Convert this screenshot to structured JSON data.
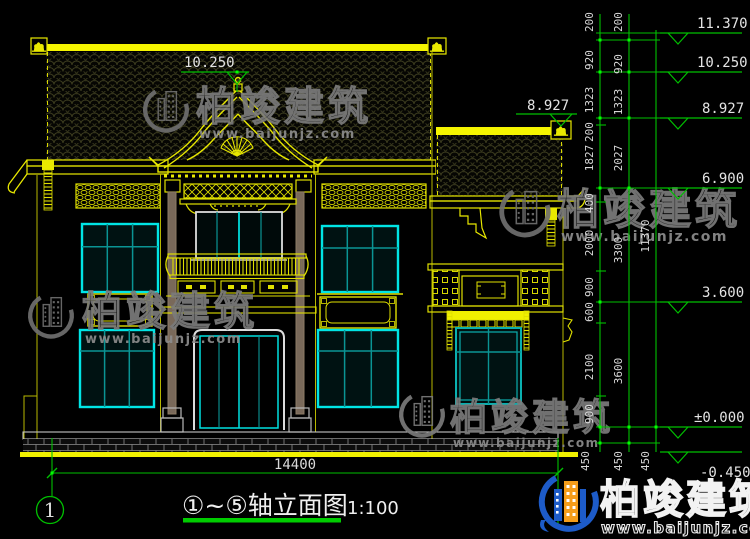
{
  "drawing": {
    "title": "①~⑤轴立面图",
    "scale": "1:100",
    "axis_start_bubble": "1",
    "total_width_dim": "14400",
    "levels": [
      "11.370",
      "10.250",
      "8.927",
      "6.900",
      "3.600",
      "±0.000",
      "-0.450"
    ],
    "gable_level": "10.250",
    "wing_level": "8.927",
    "dim_chain_inner": [
      "200",
      "920",
      "1323",
      "200",
      "1827",
      "400",
      "2000",
      "900",
      "600",
      "2100",
      "900",
      "450"
    ],
    "dim_chain_middle": [
      "200",
      "920",
      "1323",
      "2027",
      "3300",
      "3600",
      "450"
    ],
    "dim_chain_outer": [
      "11370",
      "450"
    ]
  },
  "watermark": {
    "brand": "柏竣建筑",
    "url": "www.baijunjz.com"
  },
  "colors": {
    "cad_yellow": "#f0f000",
    "cad_cyan": "#00e5e5",
    "cad_teal": "#0a9494",
    "dim_green": "#00c000",
    "grip_green": "#00ff00",
    "brand_blue": "#1d5bc8",
    "brand_orange": "#f59d1a"
  }
}
